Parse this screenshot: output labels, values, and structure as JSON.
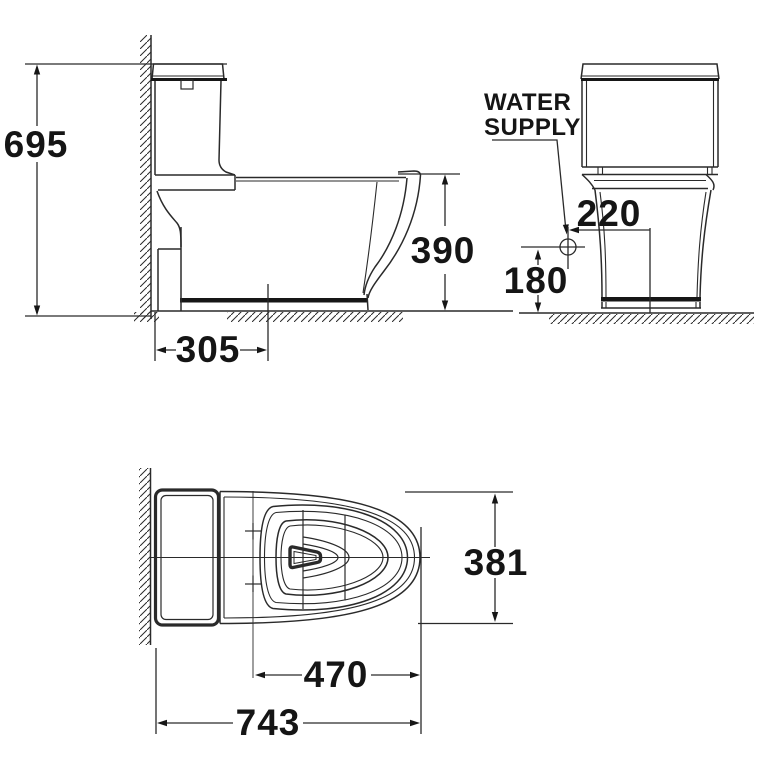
{
  "colors": {
    "background": "#ffffff",
    "line": "#2a2a2a",
    "ink": "#151515"
  },
  "labels": {
    "water_supply_line1": "WATER",
    "water_supply_line2": "SUPPLY"
  },
  "dimensions": {
    "overall_height": "695",
    "outlet_from_wall": "305",
    "bowl_height": "390",
    "supply_offset": "220",
    "supply_height": "180",
    "overall_width": "381",
    "tank_to_front": "470",
    "overall_length": "743"
  }
}
